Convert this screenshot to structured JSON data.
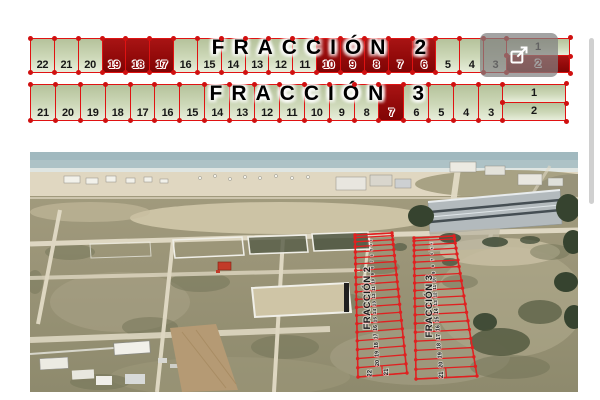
{
  "plan": {
    "colors": {
      "line": "#e01212",
      "dot": "#d01010",
      "avail_top": "#b5c29b",
      "avail_mid": "#cdd8b8",
      "avail_bottom": "#e8eedb",
      "sold_top": "#a81414",
      "sold_mid": "#930a0a",
      "sold_bottom": "#800505",
      "overlay": "rgba(128,128,128,0.72)",
      "scrollbar": "#d0d0d0",
      "photo_line": "#e02020"
    },
    "strips": [
      {
        "name": "FRACCIÓN",
        "number": "2",
        "lots": [
          {
            "n": "22"
          },
          {
            "n": "21"
          },
          {
            "n": "20"
          },
          {
            "n": "19",
            "sold": true
          },
          {
            "n": "18",
            "sold": true
          },
          {
            "n": "17",
            "sold": true
          },
          {
            "n": "16"
          },
          {
            "n": "15"
          },
          {
            "n": "14"
          },
          {
            "n": "13"
          },
          {
            "n": "12"
          },
          {
            "n": "11"
          },
          {
            "n": "10",
            "sold": true
          },
          {
            "n": "9",
            "sold": true
          },
          {
            "n": "8",
            "sold": true
          },
          {
            "n": "7",
            "sold": true
          },
          {
            "n": "6",
            "sold": true
          },
          {
            "n": "5"
          },
          {
            "n": "4"
          },
          {
            "n": "3"
          }
        ],
        "corner": [
          {
            "n": "1"
          },
          {
            "n": "2",
            "sold": true
          }
        ]
      },
      {
        "name": "FRACCIÓN",
        "number": "3",
        "lots": [
          {
            "n": "21"
          },
          {
            "n": "20"
          },
          {
            "n": "19"
          },
          {
            "n": "18"
          },
          {
            "n": "17"
          },
          {
            "n": "16"
          },
          {
            "n": "15"
          },
          {
            "n": "14"
          },
          {
            "n": "13"
          },
          {
            "n": "12"
          },
          {
            "n": "11"
          },
          {
            "n": "10"
          },
          {
            "n": "9"
          },
          {
            "n": "8"
          },
          {
            "n": "7",
            "sold": true
          },
          {
            "n": "6"
          },
          {
            "n": "5"
          },
          {
            "n": "4"
          },
          {
            "n": "3"
          }
        ],
        "corner": [
          {
            "n": "1"
          },
          {
            "n": "2"
          }
        ]
      }
    ]
  },
  "photo_overlay": {
    "strips": [
      {
        "label": "FRACCIÓN 2",
        "bottom_numbers": [
          "22",
          "21"
        ],
        "numbers": [
          "20",
          "19",
          "18",
          "17",
          "16",
          "15",
          "14",
          "13",
          "12",
          "11",
          "10",
          "9",
          "8",
          "7",
          "6",
          "5",
          "4",
          "3",
          "2"
        ]
      },
      {
        "label": "FRACCIÓN 3",
        "bottom_numbers": [
          "21"
        ],
        "numbers": [
          "20",
          "19",
          "18",
          "17",
          "16",
          "15",
          "14",
          "13",
          "12",
          "11",
          "10",
          "9",
          "8",
          "7",
          "6",
          "5",
          "4",
          "3",
          "2"
        ]
      }
    ]
  }
}
